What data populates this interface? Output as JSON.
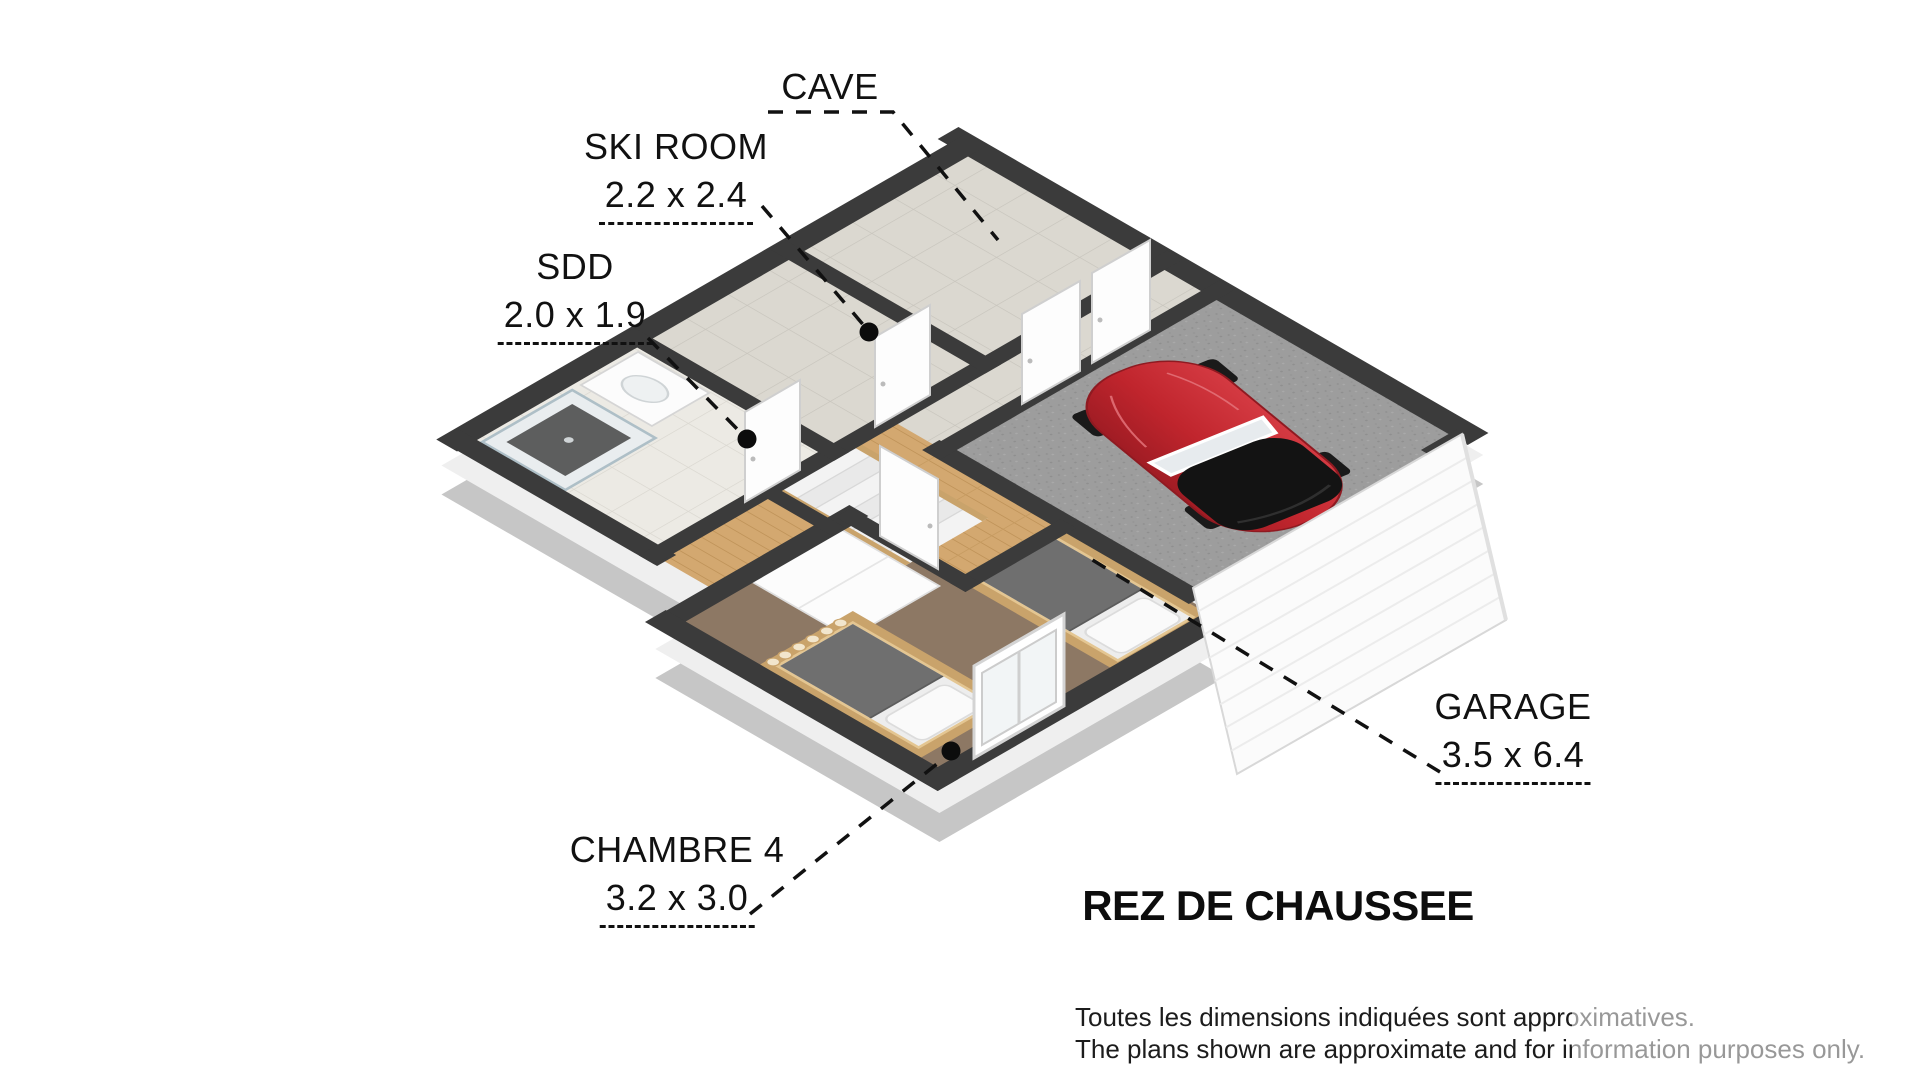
{
  "plan_title": "REZ DE CHAUSSEE",
  "rooms": [
    {
      "name": "CAVE",
      "dims": ""
    },
    {
      "name": "SKI ROOM",
      "dims": "2.2 x 2.4"
    },
    {
      "name": "SDD",
      "dims": "2.0 x 1.9"
    },
    {
      "name": "GARAGE",
      "dims": "3.5 x 6.4"
    },
    {
      "name": "CHAMBRE 4",
      "dims": "3.2 x 3.0"
    }
  ],
  "disclaimer": {
    "line1": "Toutes les dimensions indiquées sont approximatives.",
    "line2": "The plans shown are approximate and for information purposes only."
  },
  "colors": {
    "wall": "#3b3b3b",
    "car_red": "#c0252d",
    "tile_floor": "#dbd8d0",
    "wood_floor": "#d3a870",
    "concrete_floor": "#9d9d9d",
    "carpet_floor": "#8d7864",
    "label_text": "#111111"
  }
}
